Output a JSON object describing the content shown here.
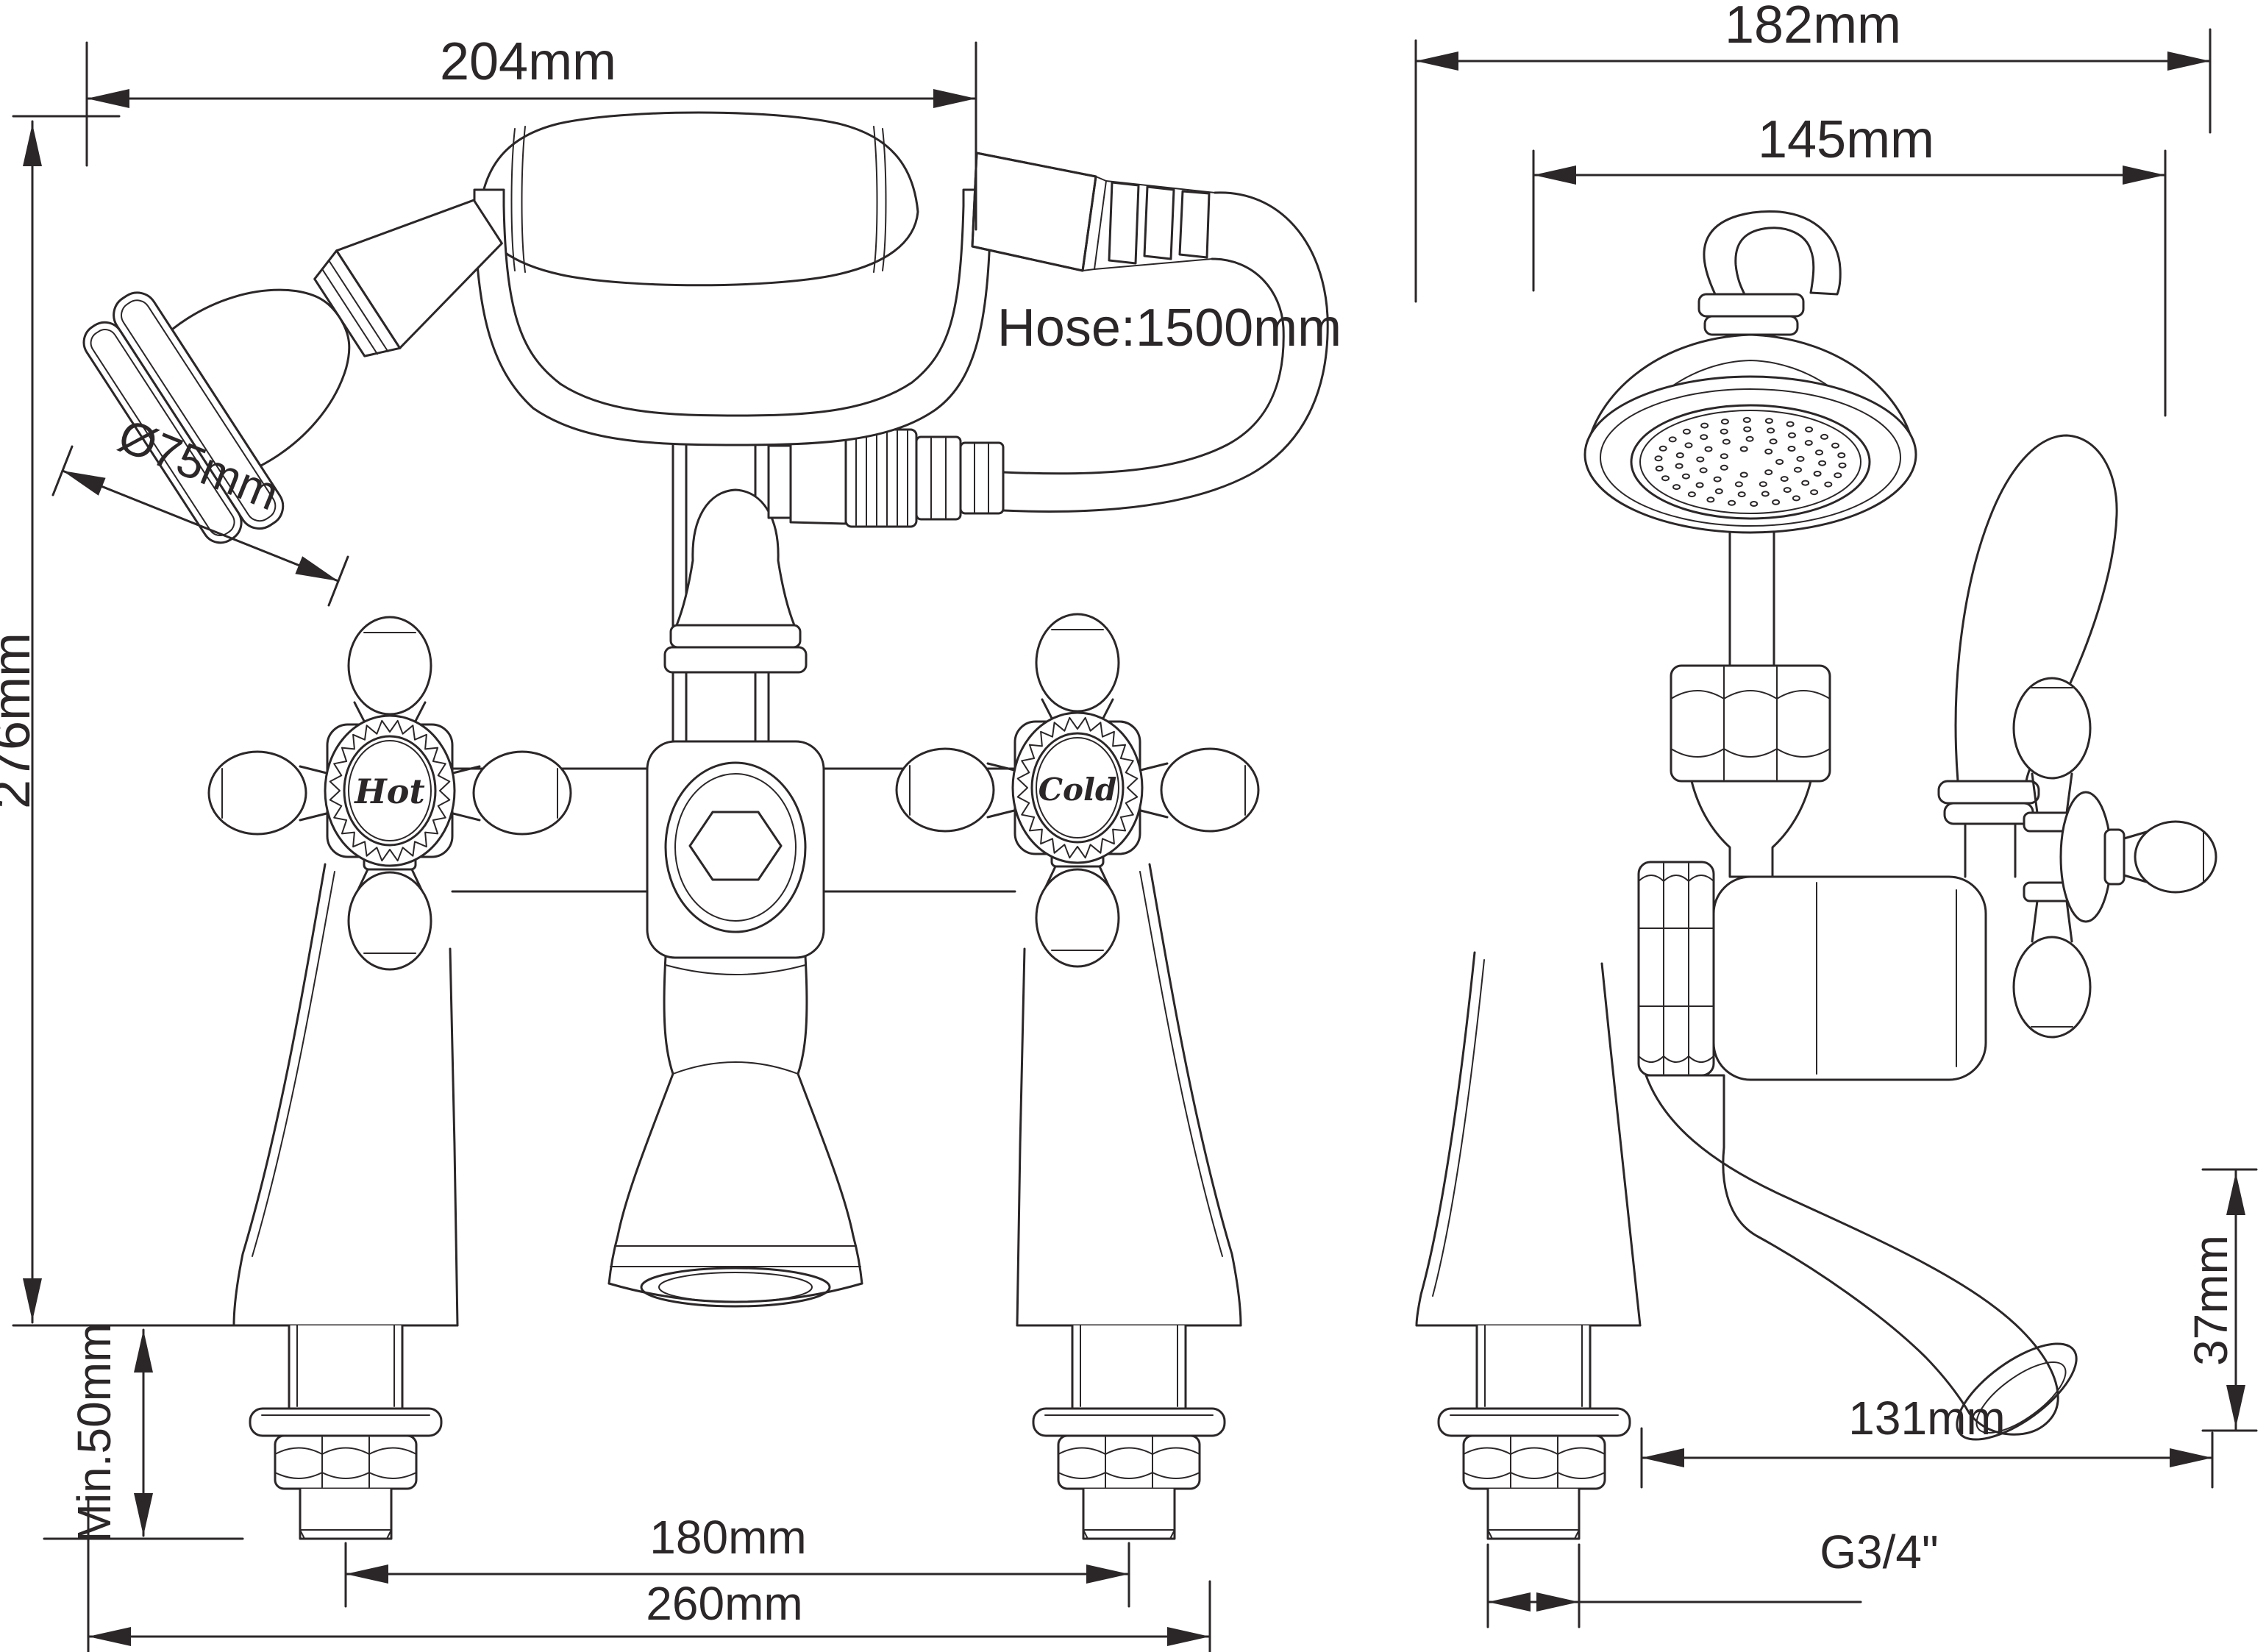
{
  "front_view": {
    "dim_width_top": "204mm",
    "dim_height": "276mm",
    "dim_head_diameter": "Ø75mm",
    "hose_length_label": "Hose:1500mm",
    "handle_hot": "Hot",
    "handle_cold": "Cold",
    "dim_min_deck": "Min.50mm",
    "dim_inlet_centres": "180mm",
    "dim_overall_width": "260mm"
  },
  "side_view": {
    "dim_overall_depth": "182mm",
    "dim_head_offset": "145mm",
    "dim_spout_drop": "37mm",
    "dim_spout_reach": "131mm",
    "thread_size": "G3/4\""
  },
  "colors": {
    "line": "#2b2728",
    "background": "#ffffff"
  }
}
